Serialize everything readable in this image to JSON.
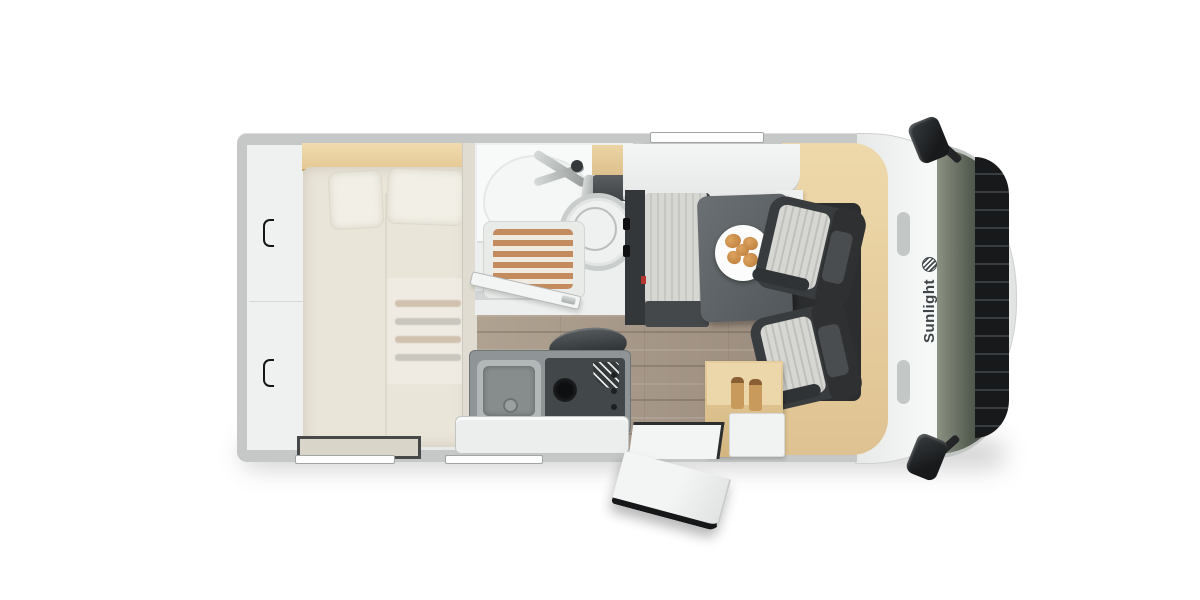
{
  "brand": {
    "name": "Sunlight",
    "logo_icon": "sunlight-logo-icon"
  },
  "image": {
    "type": "motorhome-floorplan-top-view",
    "orientation": "cab-at-right",
    "cab_seat_count": 2,
    "features": [
      "rear-garage-storage",
      "double-bed-with-two-pillows",
      "washroom-corner-sink",
      "wooden-slat-shower-tray",
      "toilet",
      "kitchen-sink",
      "three-burner-hob",
      "dinette-bench",
      "dinette-table",
      "breakfast-plate-with-croissants",
      "overhead-locker",
      "bottle-cabinet",
      "open-entry-door",
      "swivelled-cab-seats",
      "windshield",
      "two-side-mirrors"
    ]
  },
  "colors": {
    "bg": "#ffffff",
    "wall_gray": "#c6c8c7",
    "interior": "#e8eae9",
    "bed": "#eae5d9",
    "pillow": "#f2efe6",
    "wood_light": "#e5c893",
    "wood_mid": "#dfc291",
    "plank": "#a29284",
    "seat_dark": "#393c3e",
    "seat_stripe": "#d6d7d3",
    "table": "#6a7073",
    "slat": "#c48b5f",
    "windshield_a": "#8b9283",
    "windshield_b": "#565d52",
    "hood": "#17191b",
    "brand_text": "#3e4447",
    "croissant": "#b9793a"
  }
}
